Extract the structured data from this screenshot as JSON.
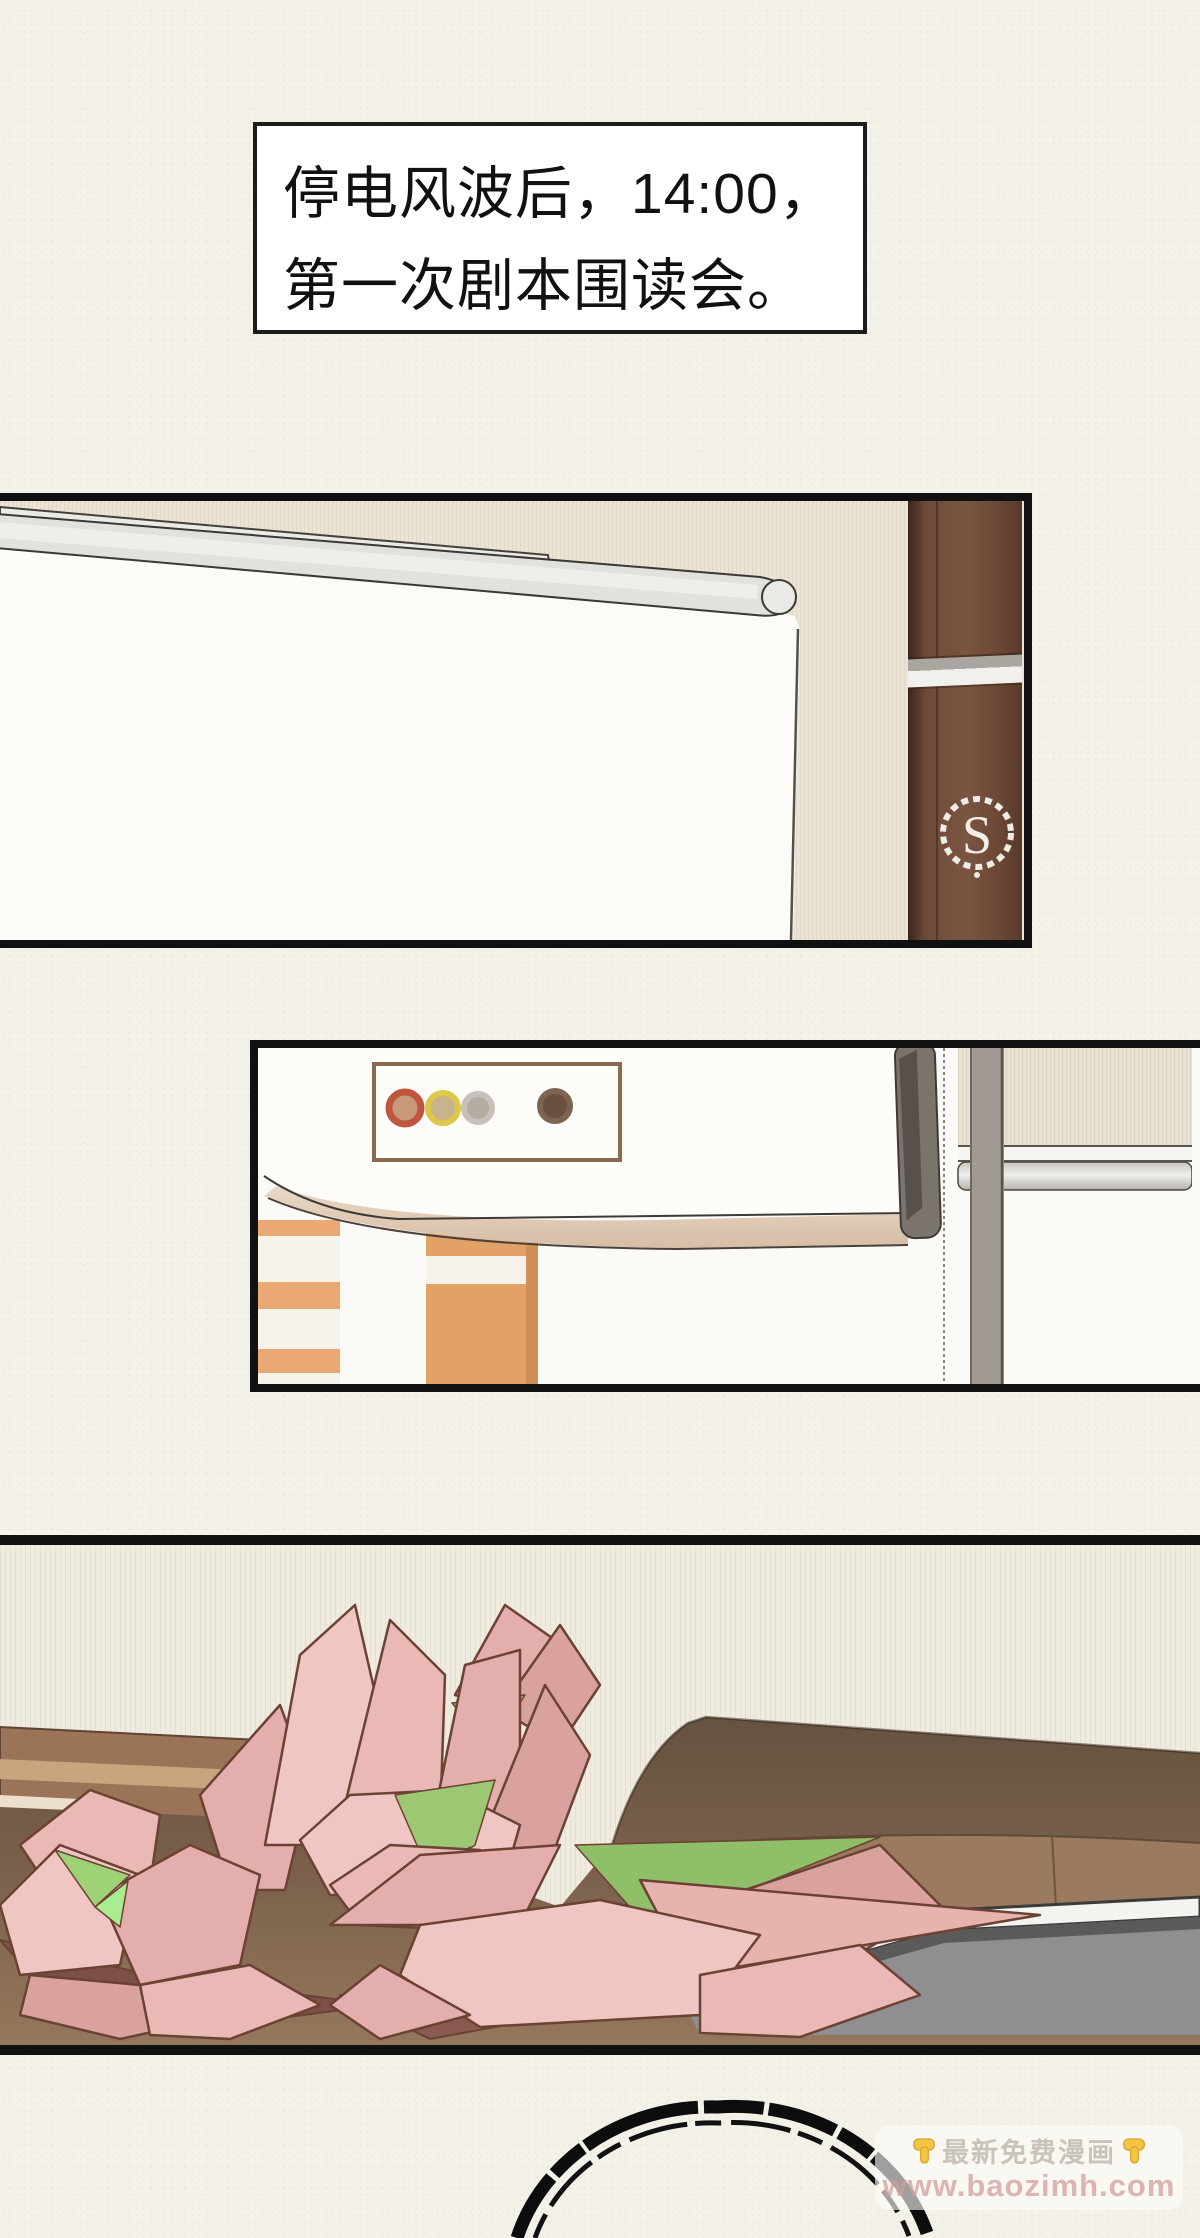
{
  "page": {
    "width": 1200,
    "height": 2238,
    "background": "#f4f1e9"
  },
  "caption": {
    "line1": "停电风波后，14:00，",
    "line2": "第一次剧本围读会。"
  },
  "panel1": {
    "description": "meeting room with projection screen and hotel pillar",
    "pillar_logo_letter": "S"
  },
  "panel2": {
    "description": "ceiling projector close-up",
    "indicator_colors": [
      "#c0563f",
      "#ddc84a",
      "#c7c1b9",
      "#7d6352"
    ],
    "indicator_inner": [
      "#c9997b",
      "#c9b28e",
      "#b5ada2",
      "#6b4f3f"
    ]
  },
  "panel3": {
    "description": "pink paper flowers on brown table with gray laptop"
  },
  "footer": {
    "watermark": {
      "hand_emoji": "👇",
      "line1": "最新免费漫画",
      "line2": "www.baozimh.com"
    }
  },
  "colors": {
    "petal_pink": "#eab9b5",
    "leaf_green": "#9cc873",
    "bright_green": "#a8ee90",
    "table_brown": "#7a604b",
    "pillar_brown": "#6e4b39",
    "cabinet_orange": "#e9a870",
    "hand_yellow": "#f5c442"
  }
}
